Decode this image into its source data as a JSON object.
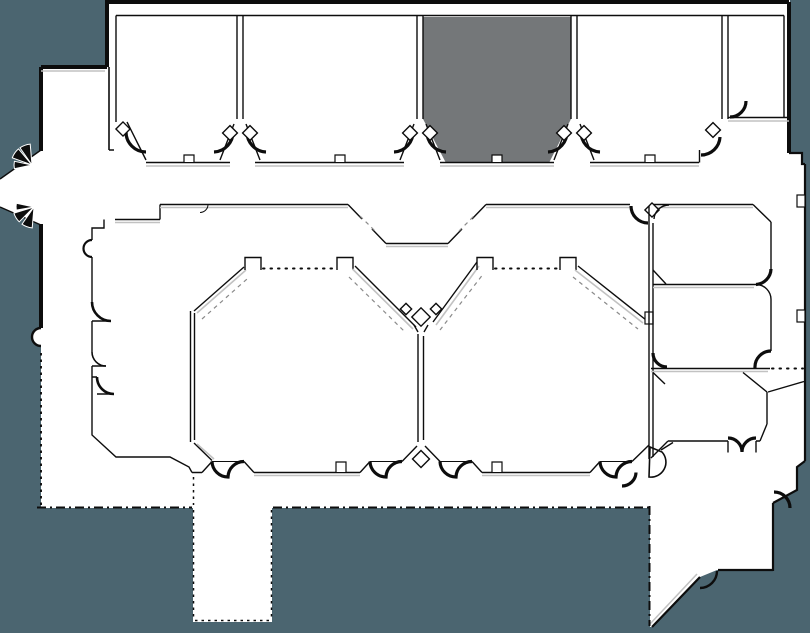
{
  "canvas": {
    "width": 810,
    "height": 633
  },
  "colors": {
    "outside": "#4b6570",
    "floor": "#ffffff",
    "wall": "#0d0d0d",
    "wall_light": "#c2c2c2",
    "dash": "#8a8a8a",
    "highlighted_room": "#747779"
  },
  "floorplan": {
    "type": "conference-level floor plan, no text labels",
    "highlighted_room": "top-row-room-3",
    "top_row_rooms": [
      "top-row-room-1",
      "top-row-room-2",
      "top-row-room-3",
      "top-row-room-4",
      "top-row-room-5"
    ],
    "center_rooms": [
      "ballroom-left",
      "ballroom-right"
    ],
    "right_wing_rooms": [
      "wing-room-a",
      "wing-room-b",
      "wing-room-c"
    ],
    "features": [
      "prefunction-hall",
      "left-entry-vestibule",
      "south-stub-corridor",
      "southeast-corridor"
    ]
  }
}
